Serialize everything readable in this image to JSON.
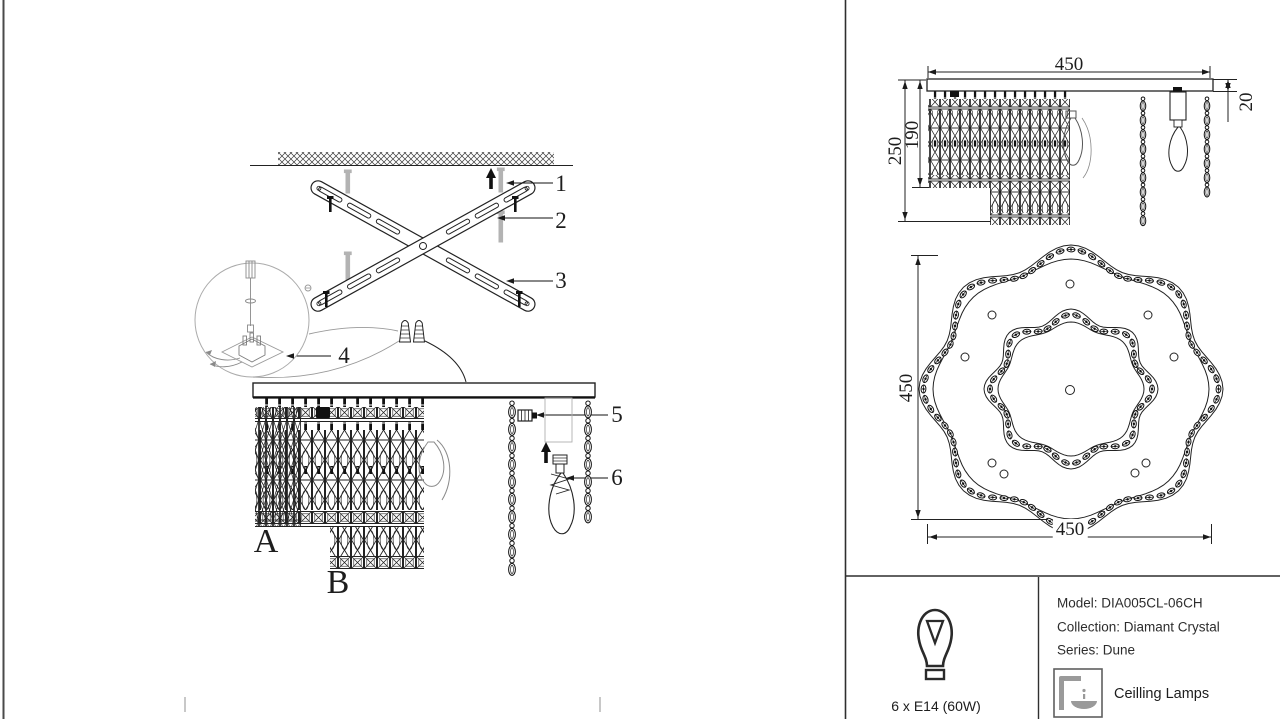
{
  "colors": {
    "line": "#1a1a1a",
    "gray": "#9e9e9e",
    "bg": "#ffffff"
  },
  "callouts": {
    "c1": "1",
    "c2": "2",
    "c3": "3",
    "c4": "4",
    "c5": "5",
    "c6": "6"
  },
  "panel_labels": {
    "a": "A",
    "b": "B"
  },
  "side_view": {
    "dim_width": "450",
    "dim_total_height": "250",
    "dim_body_height": "190",
    "dim_plate_thickness": "20"
  },
  "top_view": {
    "dim_height": "450",
    "dim_width": "450"
  },
  "spec": {
    "bulb_label": "6 x E14 (60W)",
    "model_line": "Model: DIA005CL-06CH",
    "collection_line": "Collection: Diamant Crystal",
    "series_line": "Series: Dune",
    "category_label": "Ceilling Lamps",
    "icons": {
      "bulb": "bulb-icon",
      "category": "ceiling-lamp-icon"
    }
  }
}
